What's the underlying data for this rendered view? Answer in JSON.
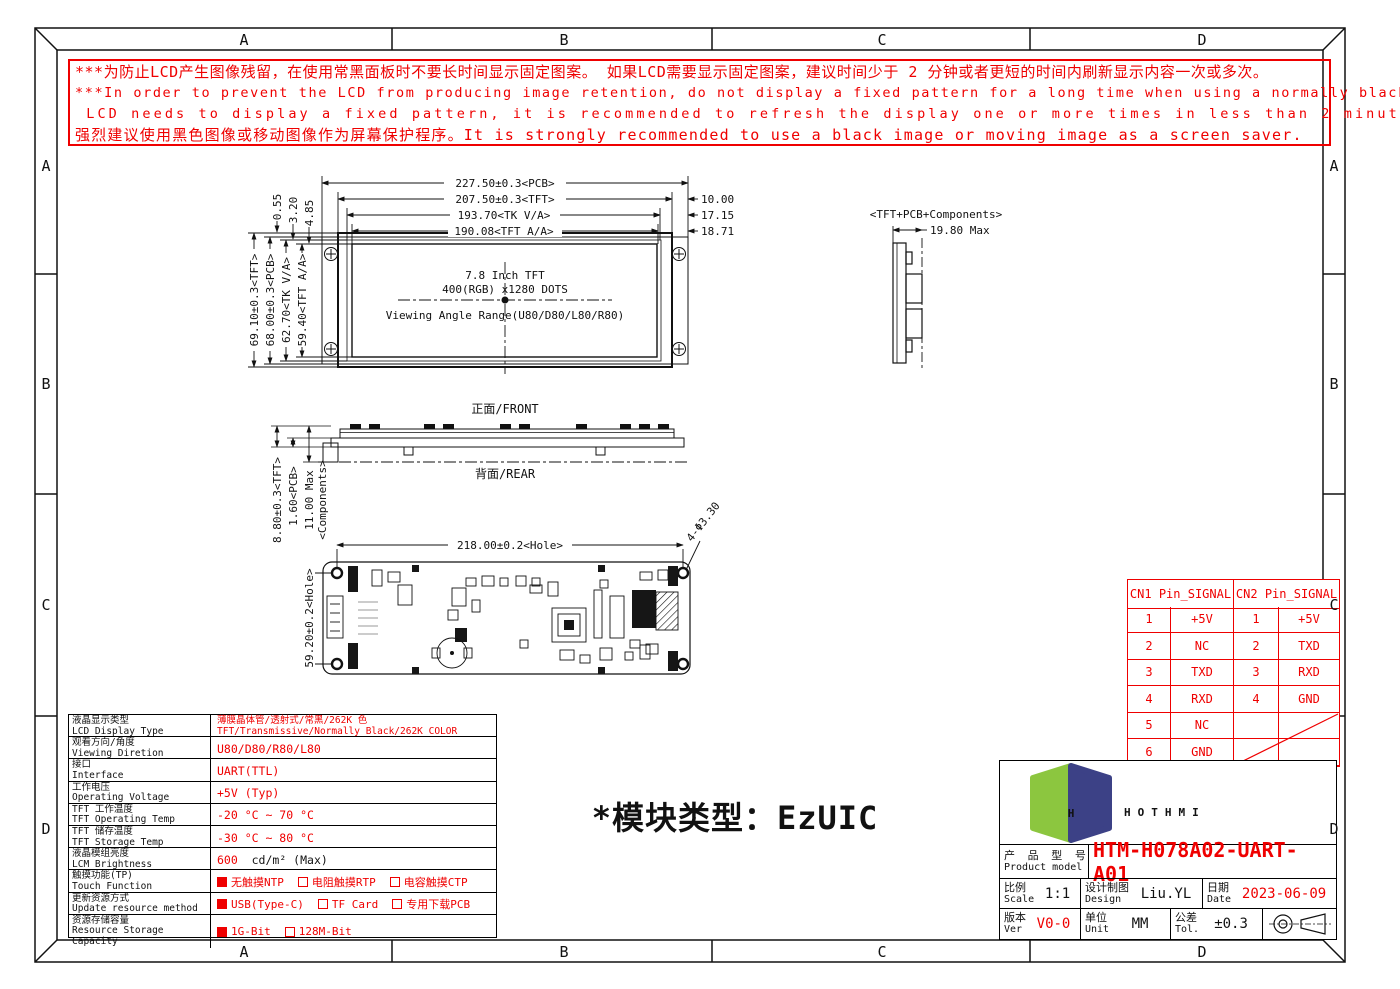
{
  "frame": {
    "zones_h": [
      "A",
      "B",
      "C",
      "D"
    ],
    "zones_v": [
      "A",
      "B",
      "C",
      "D"
    ]
  },
  "warning": {
    "lines": [
      "***为防止LCD产生图像残留，在使用常黑面板时不要长时间显示固定图案。 如果LCD需要显示固定图案，建议时间少于 2 分钟或者更短的时间内刷新显示内容一次或多次。",
      "***In order to prevent the LCD from producing image retention, do not display a fixed pattern for a long time when using a normally black panel. If the",
      " LCD needs to display a fixed pattern, it is recommended to refresh the display one or more times in less than 2 minutes or less.",
      "强烈建议使用黑色图像或移动图像作为屏幕保护程序。It is strongly recommended to use a black image or moving image as a screen saver."
    ]
  },
  "front_view": {
    "dim_pcb_w": "227.50±0.3<PCB>",
    "dim_tft_w": "207.50±0.3<TFT>",
    "dim_tkva_w": "193.70<TK V/A>",
    "dim_tftaa_w": "190.08<TFT A/A>",
    "offset_right_1": "10.00",
    "offset_right_2": "17.15",
    "offset_right_3": "18.71",
    "offset_top_1": "0.55",
    "offset_top_2": "3.20",
    "offset_top_3": "4.85",
    "dim_tft_h": "69.10±0.3<TFT>",
    "dim_pcb_h": "68.00±0.3<PCB>",
    "dim_tkva_h": "62.70<TK V/A>",
    "dim_tftaa_h": "59.40<TFT A/A>",
    "center_text_1": "7.8 Inch TFT",
    "center_text_2": "400(RGB) x1280 DOTS",
    "center_text_3": "Viewing Angle Range(U80/D80/L80/R80)"
  },
  "side_view": {
    "label": "<TFT+PCB+Components>",
    "dim_thickness": "19.80 Max"
  },
  "profile_view": {
    "front_label": "正面/FRONT",
    "rear_label": "背面/REAR",
    "dim_tft": "8.80±0.3<TFT>",
    "dim_pcb": "1.60<PCB>",
    "dim_components_1": "11.00 Max",
    "dim_components_2": "<Components>"
  },
  "pcb_view": {
    "dim_hole_w": "218.00±0.2<Hole>",
    "dim_hole_h": "59.20±0.2<Hole>",
    "dim_hole_d": "4-Φ3.30"
  },
  "module_type_note": "*模块类型：EzUIC",
  "spec_table": {
    "rows": [
      {
        "cn": "液晶显示类型",
        "en": "LCD Display Type",
        "lines": [
          "薄膜晶体管/透射式/常黑/262K 色",
          "TFT/Transmissive/Normally Black/262K COLOR"
        ]
      },
      {
        "cn": "观看方向/角度",
        "en": "Viewing Diretion",
        "value": "U80/D80/R80/L80"
      },
      {
        "cn": "接口",
        "en": "Interface",
        "value": "UART(TTL)"
      },
      {
        "cn": "工作电压",
        "en": "Operating Voltage",
        "value": "+5V (Typ)"
      },
      {
        "cn": "TFT 工作温度",
        "en": "TFT Operating Temp",
        "value": "-20 °C ~ 70 °C"
      },
      {
        "cn": "TFT 储存温度",
        "en": "TFT Storage Temp",
        "value": "-30 °C ~ 80 °C"
      },
      {
        "cn": "液晶模组亮度",
        "en": "LCM Brightness",
        "parts": [
          {
            "text": "600",
            "red": true
          },
          {
            "text": "  cd/m² (Max)",
            "red": false
          }
        ]
      },
      {
        "cn": "触摸功能(TP)",
        "en": "Touch Function",
        "checks": [
          {
            "on": true,
            "text": "无触摸NTP"
          },
          {
            "on": false,
            "text": "电阻触摸RTP"
          },
          {
            "on": false,
            "text": "电容触摸CTP"
          }
        ]
      },
      {
        "cn": "更新资源方式",
        "en": "Update resource method",
        "checks": [
          {
            "on": true,
            "text": "USB(Type-C)"
          },
          {
            "on": false,
            "text": "TF Card"
          },
          {
            "on": false,
            "text": "专用下载PCB"
          }
        ]
      },
      {
        "cn": "资源存储容量",
        "en": "Resource Storage Capacity",
        "checks": [
          {
            "on": true,
            "text": "1G-Bit"
          },
          {
            "on": false,
            "text": "128M-Bit"
          }
        ]
      }
    ]
  },
  "pin_table": {
    "headers": [
      "CN1 Pin_SIGNAL",
      "CN2 Pin_SIGNAL"
    ],
    "rows": [
      {
        "cn1": [
          "1",
          "+5V"
        ],
        "cn2": [
          "1",
          "+5V"
        ]
      },
      {
        "cn1": [
          "2",
          "NC"
        ],
        "cn2": [
          "2",
          "TXD"
        ]
      },
      {
        "cn1": [
          "3",
          "TXD"
        ],
        "cn2": [
          "3",
          "RXD"
        ]
      },
      {
        "cn1": [
          "4",
          "RXD"
        ],
        "cn2": [
          "4",
          "GND"
        ]
      },
      {
        "cn1": [
          "5",
          "NC"
        ],
        "cn2": null
      },
      {
        "cn1": [
          "6",
          "GND"
        ],
        "cn2": null
      }
    ]
  },
  "title_block": {
    "brand": "HOTHMI",
    "product_label_cn": "产 品 型 号",
    "product_label_en": "Product model",
    "product_model": "HTM-H078A02-UART-A01",
    "scale_cn": "比例",
    "scale_en": "Scale",
    "scale_value": "1:1",
    "design_cn": "设计制图",
    "design_en": "Design",
    "design_value": "Liu.YL",
    "date_cn": "日期",
    "date_en": "Date",
    "date_value": "2023-06-09",
    "ver_cn": "版本",
    "ver_en": "Ver",
    "ver_value": "V0-0",
    "unit_cn": "单位",
    "unit_en": "Unit",
    "unit_value": "MM",
    "tol_cn": "公差",
    "tol_en": "Tol.",
    "tol_value": "±0.3"
  },
  "colors": {
    "red": "#ef0000",
    "logo_green": "#8cc63f",
    "logo_navy": "#3c4186",
    "logo_gray": "#58595b"
  }
}
